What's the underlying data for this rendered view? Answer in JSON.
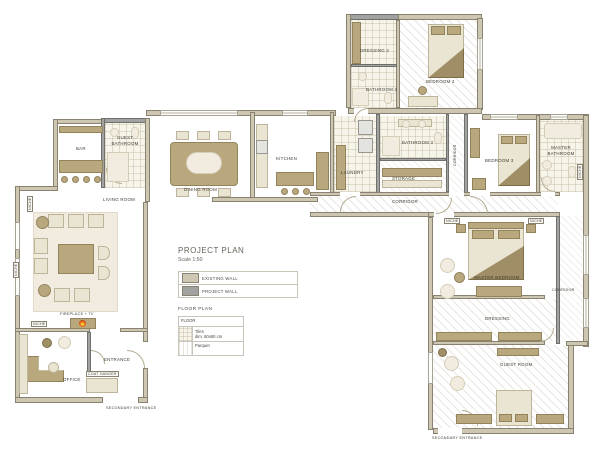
{
  "plan": {
    "title": "PROJECT PLAN",
    "scale": "Scale 1:50",
    "legend": {
      "items": [
        {
          "label": "EXISTING WALL",
          "color": "#cdc6b1"
        },
        {
          "label": "PROJECT WALL",
          "color": "#a2a2a0"
        }
      ],
      "floor_heading": "FLOOR PLAN",
      "floor_table": {
        "header": "FLOOR",
        "rows": [
          {
            "name": "Tiles",
            "detail": "dim. 60x60 cm"
          },
          {
            "name": "Parquet",
            "detail": ""
          }
        ]
      }
    },
    "rooms": {
      "dressing2": "DRESSING 2",
      "bathroom2": "BATHROOM 2",
      "bedroom2": "BEDROOM 2",
      "bar": "BAR",
      "guest_bathroom": "GUEST BATHROOM",
      "dining_room": "DINING ROOM",
      "kitchen": "KITCHEN",
      "laundry": "LAUNDRY",
      "storage": "STORAGE",
      "bathroom3": "BATHROOM 3",
      "corridor_small": "CORRIDOR",
      "bedroom3": "BEDROOM 3",
      "master_bathroom": "MASTER BATHROOM",
      "corridor_main": "CORRIDOR",
      "living_room": "LIVING ROOM",
      "entrance": "ENTRANCE",
      "office": "OFFICE",
      "master_bedroom": "MASTER BEDROOM",
      "dressing": "DRESSING",
      "corridor_right": "CORRIDOR",
      "guest_room": "GUEST ROOM"
    },
    "annotations": {
      "fireplace": "FIREPLACE + TV",
      "coat_hanger": "COAT HANGER",
      "niche": "NICHE",
      "secondary_entrance": "SECONDARY ENTRANCE"
    },
    "colors": {
      "existing_wall": "#cdc6b1",
      "project_wall": "#a2a2a0",
      "furniture": "#b9a87e",
      "furniture_light": "#eae5d3",
      "fire_accent": "#e67817"
    }
  }
}
